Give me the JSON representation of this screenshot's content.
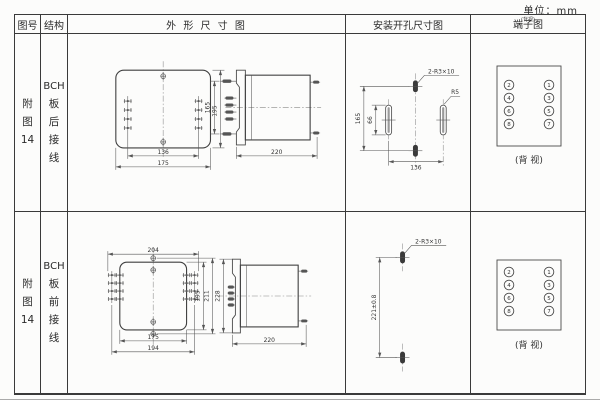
{
  "unit_label": "单位：mm",
  "header": {
    "figure_col": "图号",
    "structure_col": "结构",
    "outline_col": "外 形 尺 寸 图",
    "mounting_col": "安装开孔尺寸图",
    "terminal_col": "端子图",
    "terminal_col_note": "(背视)"
  },
  "rows": [
    {
      "figure_no": [
        "附",
        "图",
        "14"
      ],
      "structure": [
        "BCH",
        "板",
        "后",
        "接",
        "线"
      ],
      "outline": {
        "front_height": "195",
        "front_width_inner": "136",
        "front_width_outer": "175",
        "side_height": "165",
        "side_depth": "220"
      },
      "mounting": {
        "slot_label": "2-R3×10",
        "radius_label": "R5",
        "height": "165",
        "slot_height": "66",
        "width": "136"
      },
      "terminal": {
        "left": [
          "2",
          "4",
          "6",
          "8"
        ],
        "right": [
          "1",
          "3",
          "5",
          "7"
        ],
        "caption": "(背 视)"
      }
    },
    {
      "figure_no": [
        "附",
        "图",
        "14"
      ],
      "structure": [
        "BCH",
        "板",
        "前",
        "接",
        "线"
      ],
      "outline": {
        "front_width_top": "204",
        "front_width_inner": "175",
        "front_width_outer": "194",
        "front_height_inner": "195",
        "front_height_outer": "211",
        "side_height": "228",
        "side_depth": "220"
      },
      "mounting": {
        "slot_label": "2-R3×10",
        "height": "221±0.8"
      },
      "terminal": {
        "left": [
          "2",
          "4",
          "6",
          "8"
        ],
        "right": [
          "1",
          "3",
          "5",
          "7"
        ],
        "caption": "(背 视)"
      }
    }
  ]
}
